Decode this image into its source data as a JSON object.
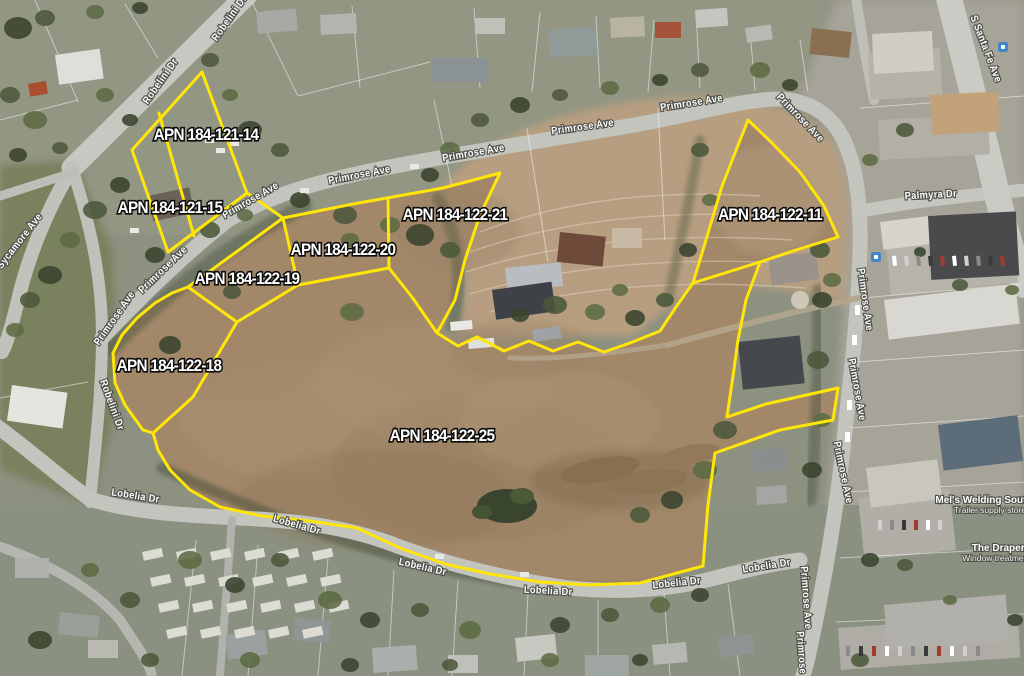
{
  "map": {
    "type": "aerial-parcel-map",
    "colors": {
      "parcel_outline": "#ffe608",
      "apn_label_fill": "#ffffff",
      "apn_label_stroke": "#0b0b0b",
      "street_label_fill": "#fdfdfd",
      "dirt_field": "#a28769",
      "transit_icon": "#4285c8"
    },
    "parcels": [
      {
        "apn": "APN 184-121-14",
        "label_x": 206,
        "label_y": 140
      },
      {
        "apn": "APN 184-121-15",
        "label_x": 170,
        "label_y": 213
      },
      {
        "apn": "APN 184-122-21",
        "label_x": 455,
        "label_y": 220
      },
      {
        "apn": "APN 184-122-20",
        "label_x": 343,
        "label_y": 255
      },
      {
        "apn": "APN 184-122-19",
        "label_x": 247,
        "label_y": 284
      },
      {
        "apn": "APN 184-122-18",
        "label_x": 169,
        "label_y": 371
      },
      {
        "apn": "APN 184-122-11",
        "label_x": 770,
        "label_y": 220
      },
      {
        "apn": "APN 184-122-25",
        "label_x": 442,
        "label_y": 441
      }
    ],
    "streets": [
      {
        "name": "Robelini Dr",
        "x": 232,
        "y": 20,
        "rot": -55
      },
      {
        "name": "Robelini Dr",
        "x": 163,
        "y": 83,
        "rot": -55
      },
      {
        "name": "Robelini Dr",
        "x": 109,
        "y": 406,
        "rot": 70
      },
      {
        "name": "Sycamore Ave",
        "x": 22,
        "y": 243,
        "rot": -52
      },
      {
        "name": "Primrose Ave",
        "x": 117,
        "y": 320,
        "rot": -55
      },
      {
        "name": "Primrose Ave",
        "x": 165,
        "y": 272,
        "rot": -44
      },
      {
        "name": "Primrose Ave",
        "x": 252,
        "y": 203,
        "rot": -30
      },
      {
        "name": "Primrose Ave",
        "x": 360,
        "y": 178,
        "rot": -11
      },
      {
        "name": "Primrose Ave",
        "x": 474,
        "y": 156,
        "rot": -10
      },
      {
        "name": "Primrose Ave",
        "x": 583,
        "y": 130,
        "rot": -8
      },
      {
        "name": "Primrose Ave",
        "x": 692,
        "y": 106,
        "rot": -9
      },
      {
        "name": "Primrose Ave",
        "x": 798,
        "y": 120,
        "rot": 46
      },
      {
        "name": "Primrose Ave",
        "x": 862,
        "y": 300,
        "rot": 82
      },
      {
        "name": "Primrose Ave",
        "x": 854,
        "y": 390,
        "rot": 80
      },
      {
        "name": "Primrose Ave",
        "x": 840,
        "y": 473,
        "rot": 78
      },
      {
        "name": "Primrose Ave",
        "x": 803,
        "y": 598,
        "rot": 86
      },
      {
        "name": "Primrose Ave",
        "x": 799,
        "y": 663,
        "rot": 86
      },
      {
        "name": "Palmyra Dr",
        "x": 931,
        "y": 198,
        "rot": -3
      },
      {
        "name": "S Santa Fe Ave",
        "x": 983,
        "y": 50,
        "rot": 69
      },
      {
        "name": "Lobelia Dr",
        "x": 135,
        "y": 499,
        "rot": 9
      },
      {
        "name": "Lobelia Dr",
        "x": 296,
        "y": 528,
        "rot": 16
      },
      {
        "name": "Lobelia Dr",
        "x": 422,
        "y": 570,
        "rot": 13
      },
      {
        "name": "Lobelia Dr",
        "x": 548,
        "y": 594,
        "rot": 3
      },
      {
        "name": "Lobelia Dr",
        "x": 677,
        "y": 586,
        "rot": -6
      },
      {
        "name": "Lobelia Dr",
        "x": 767,
        "y": 569,
        "rot": -9
      }
    ],
    "places": [
      {
        "name": "Mel's Welding South",
        "detail": "Trailer supply store",
        "x": 984,
        "y": 503
      },
      {
        "name": "The Drapery",
        "detail": "Window treatment store",
        "x": 1001,
        "y": 551
      }
    ]
  }
}
